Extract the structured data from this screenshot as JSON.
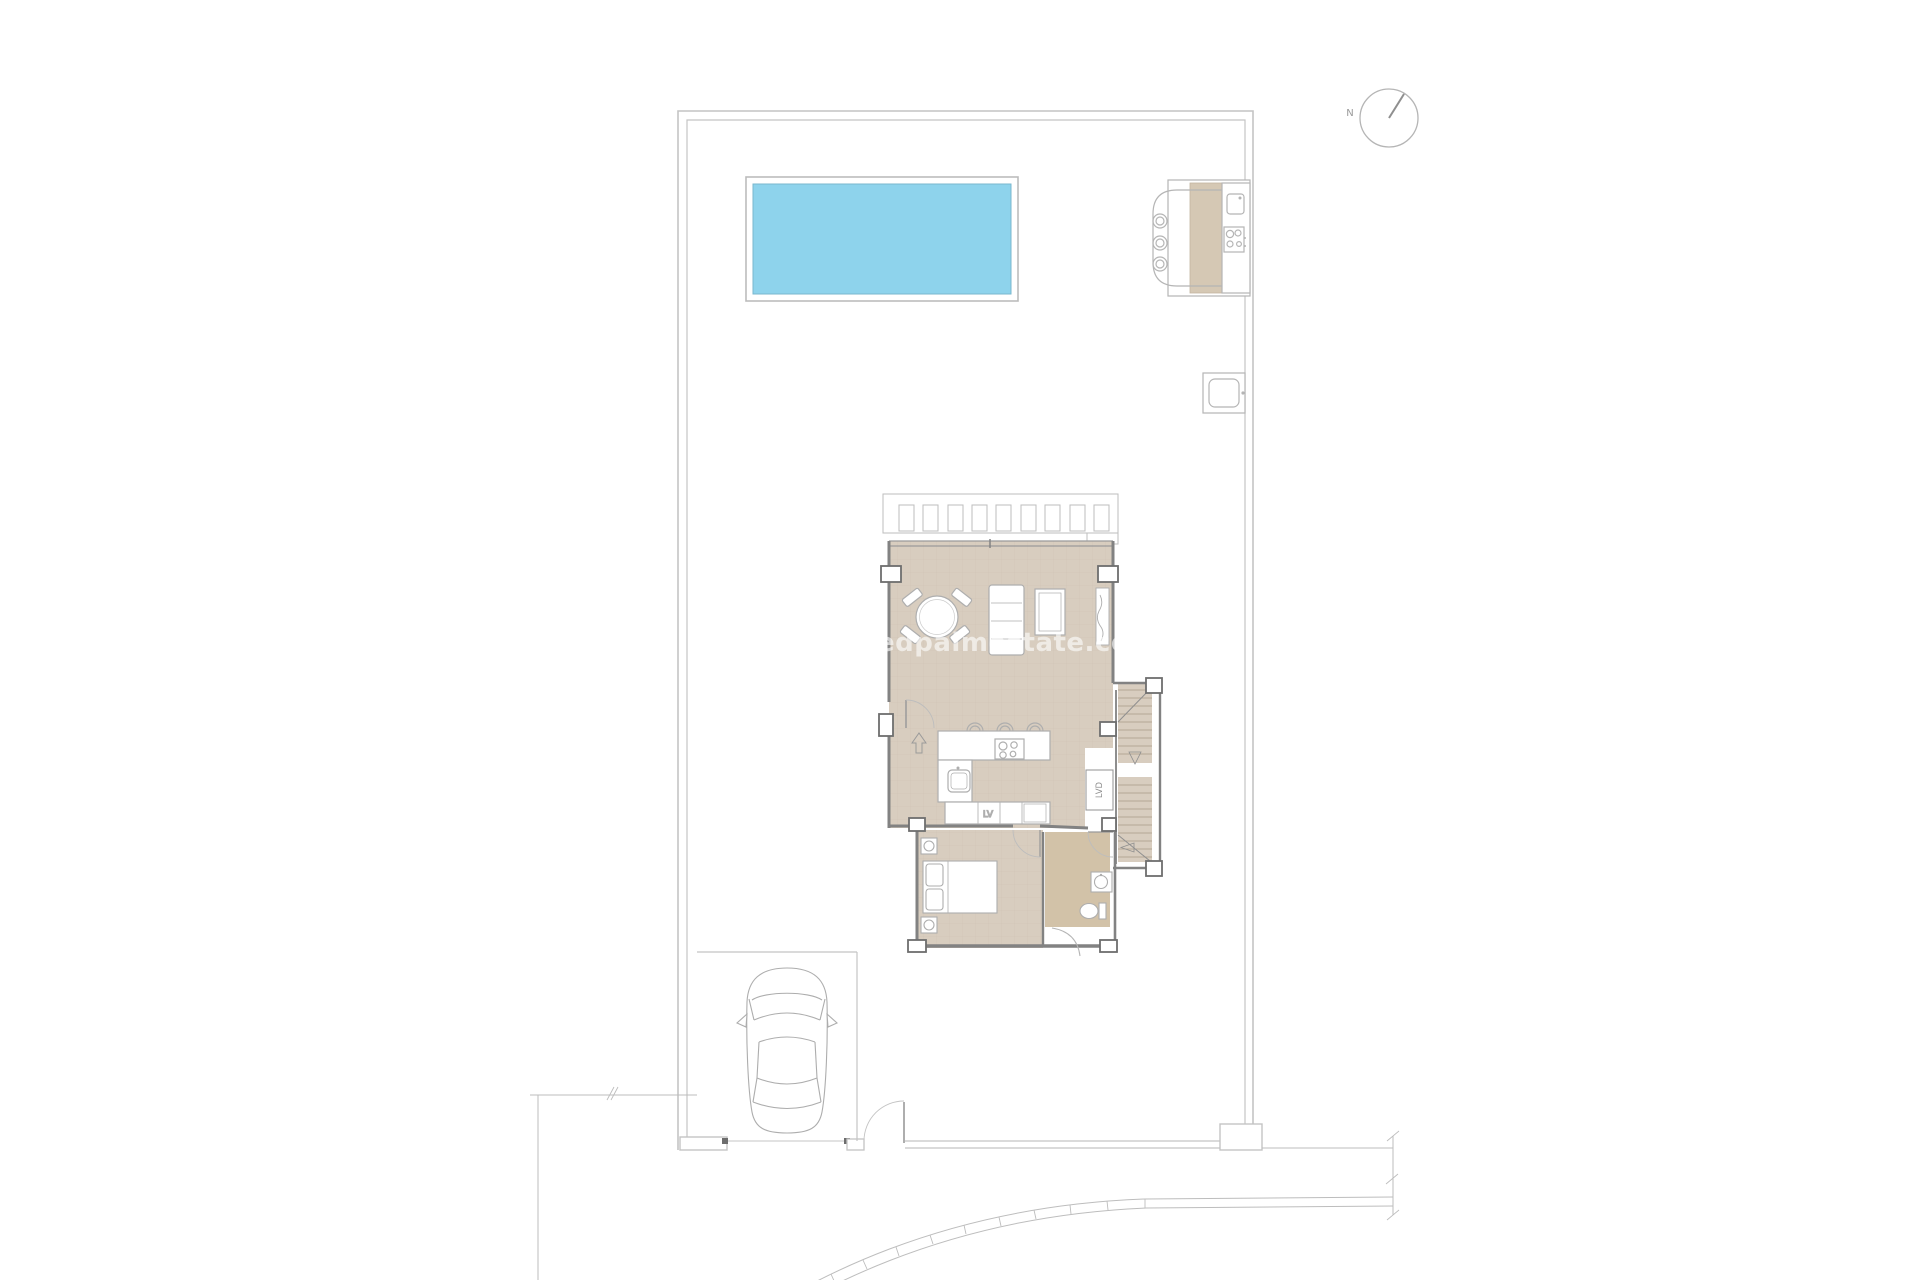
{
  "title": "Villa plot ground floor plan",
  "compass": {
    "label": "N"
  },
  "watermark": {
    "text": "edpalmestate.com"
  },
  "plan": {
    "kitchen": {
      "dishwasher_label": "LV"
    },
    "laundry": {
      "washer_label": "LVD"
    }
  },
  "colors": {
    "pool_water": "#8ed3ec",
    "pool_edge": "#79b7ce",
    "floor_tile": "#d8cdbf",
    "bathroom_floor": "#d2c2a8",
    "stair_tread": "#d8cdbf",
    "outdoor_counter": "#d5c8b4",
    "wall": "#828282",
    "furniture_line": "#aeaeae",
    "boundary_line": "#c4c4c4",
    "watermark": "#ffffff"
  },
  "features": [
    "plot-boundary",
    "swimming-pool",
    "outdoor-kitchen",
    "bar-stools",
    "outdoor-shower",
    "north-compass",
    "pergola",
    "living-dining-room",
    "sofa",
    "dining-table",
    "kitchen-island",
    "staircase",
    "bedroom",
    "bathroom",
    "laundry-closet",
    "parking-car",
    "driveway-gate",
    "pedestrian-gate",
    "road-curb"
  ]
}
